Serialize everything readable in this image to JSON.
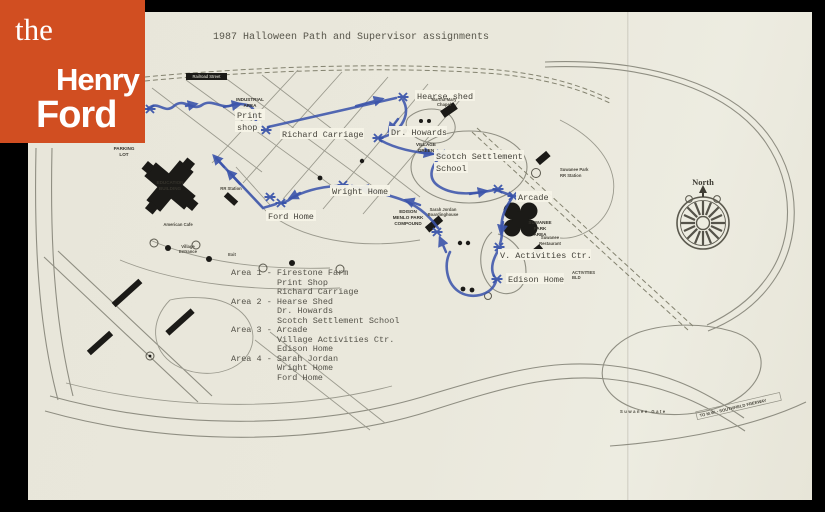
{
  "document": {
    "title": "1987 Halloween Path and Supervisor assignments"
  },
  "logo": {
    "line1": "the",
    "line2": "Henry",
    "line3": "Ford",
    "bg_color": "#d14e21"
  },
  "colors": {
    "paper": "#e9e7dc",
    "path_blue": "#3b54ab",
    "road_gray": "#8f8e82",
    "ink": "#55534a",
    "logo_orange": "#d14e21"
  },
  "legend": {
    "lines": [
      "Area 1 - Firestone Farm",
      "Print Shop",
      "Richard Carriage",
      "Area 2 - Hearse Shed",
      "Dr. Howards",
      "Scotch Settlement School",
      "Area 3 - Arcade",
      "Village Activities Ctr.",
      "Edison Home",
      "Area 4 - Sarah Jordan",
      "Wright Home",
      "Ford Home"
    ]
  },
  "map": {
    "labels": {
      "railroad_street": "Railroad Street",
      "industrial_area_1": "INDUSTRIAL",
      "industrial_area_2": "AREA",
      "hearse_shed": "Hearse shed",
      "print_shop_1": "Print",
      "print_shop_2": "shop",
      "richard_carriage": "Richard Carriage",
      "dr_howards": "Dr. Howards",
      "martha_mary_1": "Martha-Mary",
      "martha_mary_2": "Chapel",
      "village_green_1": "VILLAGE",
      "village_green_2": "GREEN",
      "scotch_1": "Scotch Settlement",
      "scotch_2": "School",
      "wright_home": "Wright Home",
      "ford_home": "Ford Home",
      "edison_menlo_1": "EDISON",
      "edison_menlo_2": "MENLO PARK",
      "edison_menlo_3": "COMPOUND",
      "sarah_jordan_1": "Sarah Jordan",
      "sarah_jordan_2": "Boardinghouse",
      "suwanee_station_1": "Suwanee Park",
      "suwanee_station_2": "RR Station",
      "arcade": "Arcade",
      "suwanee_park_1": "SUWANEE",
      "suwanee_park_2": "PARK",
      "suwanee_park_3": "AREA",
      "suwanee_restaurant_1": "Suwanee",
      "suwanee_restaurant_2": "Restaurant",
      "activities_ctr": "V. Activities Ctr.",
      "activities_bld_1": "ACTIVITIES",
      "activities_bld_2": "BLD",
      "edison_home": "Edison Home",
      "education_1": "EDUCATION",
      "education_2": "BUILDING",
      "parking_1": "PARKING",
      "parking_2": "LOT",
      "american_cafe": "American Cafe",
      "village_entrance_1": "Village",
      "village_entrance_2": "Entrance",
      "exit": "Exit",
      "rr_station": "RR Station",
      "north": "North",
      "suwanee_gate": "Suwanee Gate",
      "freeway": "TO M.W. - SOUTHFIELD FREEWAY"
    }
  }
}
